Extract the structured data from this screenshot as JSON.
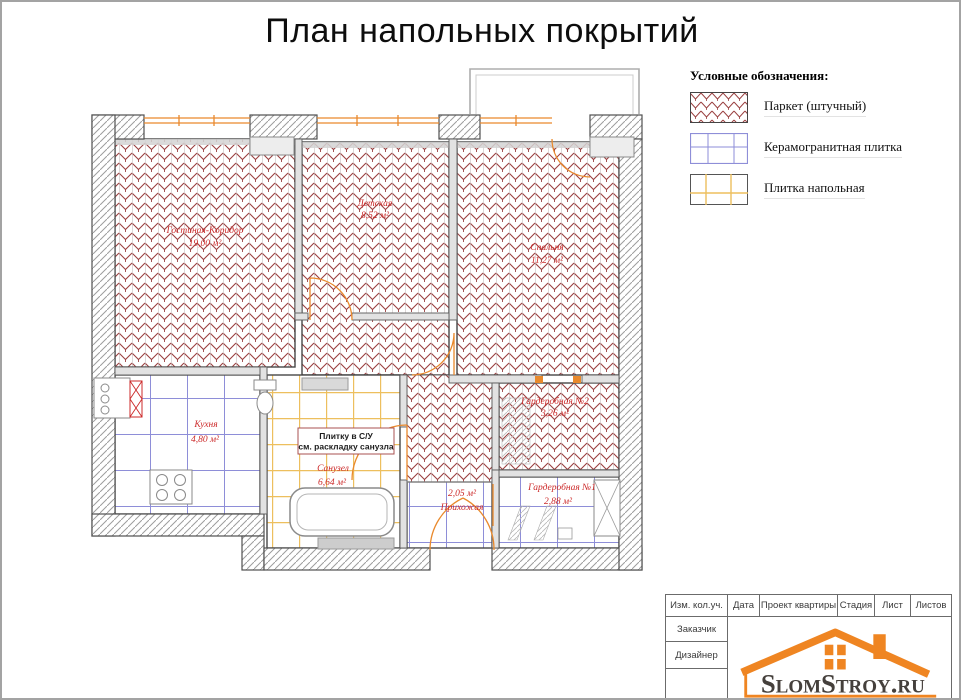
{
  "page": {
    "title": "План напольных покрытий"
  },
  "legend": {
    "title": "Условные обозначения:",
    "items": [
      {
        "label": "Паркет (штучный)"
      },
      {
        "label": "Керамогранитная плитка"
      },
      {
        "label": "Плитка напольная"
      }
    ]
  },
  "plan": {
    "rooms": [
      {
        "name": "Гостиная-Коридор",
        "area": "19,00 м²",
        "covering": "паркет"
      },
      {
        "name": "Детская",
        "area": "8,52 м²",
        "covering": "паркет"
      },
      {
        "name": "Спальня",
        "area": "11,27 м²",
        "covering": "паркет"
      },
      {
        "name": "Кухня",
        "area": "4,80 м²",
        "covering": "керамогранитная плитка"
      },
      {
        "name": "Санузел",
        "area": "6,64 м²",
        "covering": "плитка напольная"
      },
      {
        "name": "Прихожая",
        "area": "2,05 м²",
        "covering": "керамогранитная плитка"
      },
      {
        "name": "Гардеробная №1",
        "area": "2,88 м²",
        "covering": "керамогранитная плитка"
      },
      {
        "name": "Гардеробная №2",
        "area": "3,26 м²",
        "covering": "паркет"
      }
    ],
    "note_line1": "Плитку в С/У",
    "note_line2": "см. раскладку санузла"
  },
  "titleblock": {
    "col1": "Изм. кол.уч.",
    "col2": "Дата",
    "col3": "Проект квартиры",
    "col4": "Стадия",
    "col5": "Лист",
    "col6": "Листов",
    "row1": "Заказчик",
    "row2": "Дизайнер",
    "logo": "SlomStroy.ru"
  },
  "colors": {
    "parquet_line": "#9a4040",
    "ceramic_line": "#8e8ed8",
    "floor_tile_line": "#edbf5e",
    "accent_orange": "#ef8522",
    "label_red": "#cc2a2a",
    "wall_hatch": "#9d9d9d"
  }
}
